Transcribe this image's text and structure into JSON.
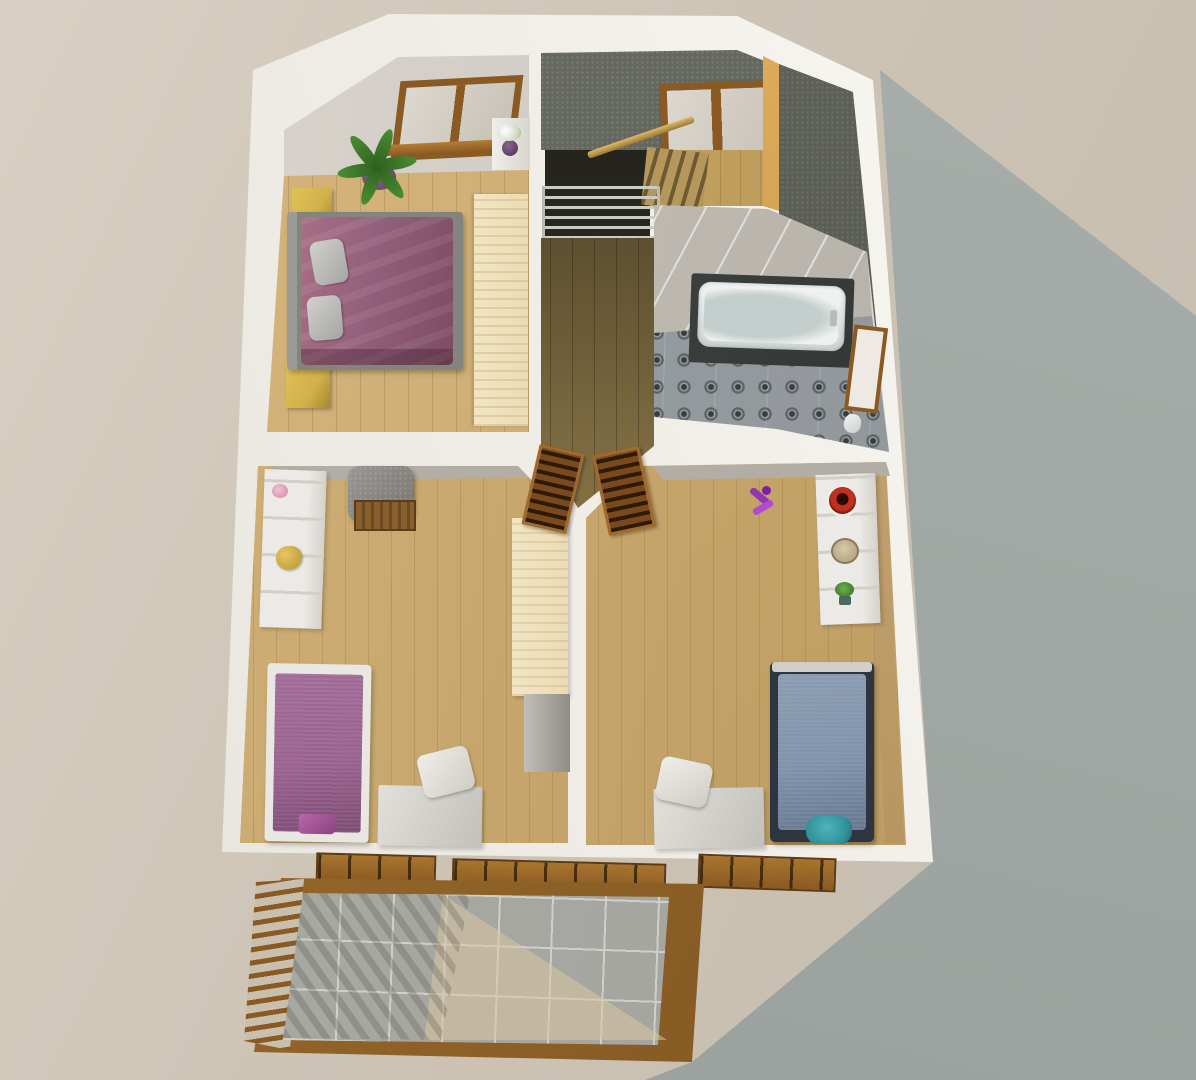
{
  "meta": {
    "description": "3D architectural render, bird's-eye view of an upper storey floor plan with two child bedrooms, a master bedroom, bathroom, stair landing and a tiled balcony",
    "view": "top-down",
    "visible_text": "none"
  },
  "colors": {
    "ground": "#cdc4b6",
    "ground-light": "#d8d0c2",
    "cast-shadow": "#a1a8a5",
    "wall-bright": "#fbfaf6",
    "wall-shade": "#b2aea5",
    "wood": "#c3a369",
    "wood-light": "#d7b77e",
    "wood-dark": "#8d7848",
    "dark-ceiling": "#5d6057",
    "attic": "#555850",
    "frame-brown": "#8a5a22",
    "louver-brown": "#7a4a1d",
    "plum": "#93607b",
    "plum-deep": "#7c4c62",
    "kid-purple": "#99618e",
    "kid-blue": "#8093aa",
    "nightstand-yellow": "#d2b04a",
    "wardrobe-wood": "#ecdcb4",
    "balcony-tile": "#a6a6a1",
    "grout": "#cfcec9",
    "bath-floor": "#8f9499",
    "bath-dark": "#343836",
    "tub-white": "#eef1f0",
    "metal": "#ccccc7",
    "unit-white": "#eceae6",
    "teal": "#2f8f96",
    "leaf-green": "#4a8c34",
    "pot-purple": "#6d4b73",
    "toy-purple": "#9135b5",
    "red-accent": "#c2301f"
  },
  "rooms": {
    "exterior": {
      "label": "exterior ground with building cast shadow and white roof eaves"
    },
    "master": {
      "label": "master bedroom: double bed with plum duvet, two grey pillows, two yellow nightstands, wardrobe, potted plant, roof window, flower shelf"
    },
    "landing": {
      "label": "stair landing: staircase opening, metal guard railing, wooden handrail, roof skylight, dark sloped ceiling"
    },
    "bathroom": {
      "label": "bathroom: bathtub with dark tile surround, patterned tile floor, wooden door, toilet"
    },
    "kids_left": {
      "label": "left kids bedroom: purple single bed, white shelving, teddy bear, grey armchair, desk and chair, wardrobe, louvered door"
    },
    "kids_right": {
      "label": "right kids bedroom: blue single bed, white shelving with bowls and plant, purple toy, desk and chair, wardrobe, louvered door, teal stool"
    },
    "balcony": {
      "label": "balcony terrace: grey floor tiles, wooden railing with balusters, sunlight patch"
    }
  }
}
